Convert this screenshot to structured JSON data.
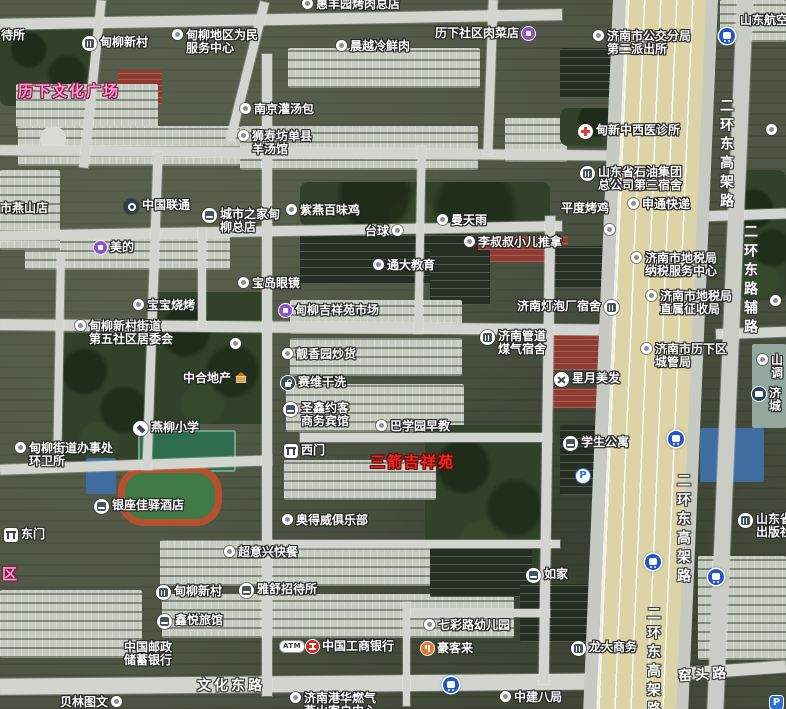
{
  "colors": {
    "poi_text": "#ffffff",
    "area_label_pink": "#ff9cc8",
    "area_label_red": "#ef2723",
    "road_fill": "#d2d5cf",
    "highway_fill": "#dcd3a6"
  },
  "icon_glyphs": {
    "parking": "P",
    "atm": "ATM"
  },
  "area_labels": [
    {
      "text": "历下文化广场",
      "x": 18,
      "y": 80,
      "style": "pink"
    },
    {
      "text": "区",
      "x": 2,
      "y": 563,
      "style": "pink"
    },
    {
      "text": "三箭吉祥苑",
      "x": 370,
      "y": 451,
      "style": "red"
    }
  ],
  "road_labels": [
    {
      "text": "二环东高架路",
      "x": 716,
      "y": 98,
      "vertical": true
    },
    {
      "text": "二环东路辅路",
      "x": 740,
      "y": 224,
      "vertical": true
    },
    {
      "text": "二环东高架路",
      "x": 673,
      "y": 473,
      "vertical": true
    },
    {
      "text": "二环东高架路",
      "x": 643,
      "y": 606,
      "vertical": true
    },
    {
      "text": "窑头路",
      "x": 678,
      "y": 664,
      "vertical": false,
      "tilt": -4
    },
    {
      "text": "文化东路",
      "x": 197,
      "y": 675,
      "vertical": false,
      "tilt": 0
    }
  ],
  "pois": [
    {
      "x": 1,
      "y": 29,
      "icon": "none",
      "lines": [
        "待所"
      ]
    },
    {
      "x": 82,
      "y": 36,
      "icon": "building",
      "lines": [
        "甸柳新村"
      ]
    },
    {
      "x": 172,
      "y": 29,
      "icon": "dot",
      "lines": [
        "甸柳地区为民",
        "服务中心"
      ]
    },
    {
      "x": 302,
      "y": -2,
      "icon": "dot",
      "lines": [
        "惠丰园烤肉总店"
      ]
    },
    {
      "x": 336,
      "y": 40,
      "icon": "dot",
      "lines": [
        "晨越冷鲜肉"
      ]
    },
    {
      "x": 435,
      "y": 27,
      "icon": "purple",
      "side": "r",
      "lines": [
        "历下社区肉菜店"
      ]
    },
    {
      "x": 593,
      "y": 30,
      "icon": "dot",
      "lines": [
        "济南市公交分局",
        "第二派出所"
      ]
    },
    {
      "x": 740,
      "y": 14,
      "icon": "none",
      "lines": [
        "山东航空"
      ]
    },
    {
      "x": 719,
      "y": 28,
      "icon": "metro",
      "lines": []
    },
    {
      "x": 240,
      "y": 103,
      "icon": "dot",
      "lines": [
        "南京灌汤包"
      ]
    },
    {
      "x": 238,
      "y": 130,
      "icon": "dot",
      "lines": [
        "狮寿坊单县",
        "羊汤馆"
      ]
    },
    {
      "x": 578,
      "y": 124,
      "icon": "hospital",
      "lines": [
        "甸新中西医诊所"
      ]
    },
    {
      "x": 580,
      "y": 166,
      "icon": "building",
      "lines": [
        "山东省石油集团",
        "总公司第三宿舍"
      ]
    },
    {
      "x": 561,
      "y": 202,
      "icon": "none",
      "lines": [
        "平度烤鸡"
      ]
    },
    {
      "x": 628,
      "y": 198,
      "icon": "dot",
      "lines": [
        "申通快递"
      ]
    },
    {
      "x": 766,
      "y": 124,
      "icon": "dot",
      "lines": []
    },
    {
      "x": 0,
      "y": 202,
      "icon": "none",
      "lines": [
        "市燕山店"
      ]
    },
    {
      "x": 124,
      "y": 199,
      "icon": "unicom",
      "lines": [
        "中国联通"
      ]
    },
    {
      "x": 202,
      "y": 208,
      "icon": "bed",
      "lines": [
        "城市之家甸",
        "柳总店"
      ]
    },
    {
      "x": 94,
      "y": 241,
      "icon": "purple",
      "lines": [
        "美的"
      ]
    },
    {
      "x": 286,
      "y": 204,
      "icon": "dot",
      "lines": [
        "紫燕百味鸡"
      ]
    },
    {
      "x": 365,
      "y": 225,
      "icon": "dot",
      "side": "r",
      "lines": [
        "台球"
      ]
    },
    {
      "x": 437,
      "y": 214,
      "icon": "dot",
      "lines": [
        "曼天雨"
      ]
    },
    {
      "x": 464,
      "y": 236,
      "icon": "dot",
      "lines": [
        "李叔叔小儿推拿"
      ]
    },
    {
      "x": 373,
      "y": 259,
      "icon": "dot",
      "lines": [
        "通大教育"
      ]
    },
    {
      "x": 238,
      "y": 277,
      "icon": "dot",
      "lines": [
        "宝岛眼镜"
      ]
    },
    {
      "x": 279,
      "y": 304,
      "icon": "purple",
      "lines": [
        "甸柳吉祥苑市场"
      ]
    },
    {
      "x": 517,
      "y": 300,
      "icon": "building",
      "side": "r",
      "lines": [
        "济南灯泡厂宿舍"
      ]
    },
    {
      "x": 631,
      "y": 252,
      "icon": "dot",
      "lines": [
        "济南市地税局",
        "纳税服务中心"
      ]
    },
    {
      "x": 646,
      "y": 290,
      "icon": "dot",
      "lines": [
        "济南市地税局",
        "直属征收局"
      ]
    },
    {
      "x": 480,
      "y": 330,
      "icon": "building",
      "lines": [
        "济南管道",
        "煤气宿舍"
      ]
    },
    {
      "x": 641,
      "y": 343,
      "icon": "dot",
      "lines": [
        "济南市历下区",
        "城管局"
      ]
    },
    {
      "x": 554,
      "y": 372,
      "icon": "scissors",
      "lines": [
        "星月美发"
      ]
    },
    {
      "x": 133,
      "y": 299,
      "icon": "dot",
      "lines": [
        "宝宝烧烤"
      ]
    },
    {
      "x": 75,
      "y": 320,
      "icon": "dot",
      "lines": [
        "甸柳新村街道",
        "第五社区居委会"
      ]
    },
    {
      "x": 183,
      "y": 372,
      "icon": "house",
      "side": "r",
      "lines": [
        "中合地产"
      ]
    },
    {
      "x": 282,
      "y": 348,
      "icon": "dot",
      "lines": [
        "靓香园炒货"
      ]
    },
    {
      "x": 281,
      "y": 376,
      "icon": "bag",
      "lines": [
        "赛维干洗"
      ]
    },
    {
      "x": 283,
      "y": 402,
      "icon": "bed",
      "lines": [
        "圣鑫约客",
        "商务宾馆"
      ]
    },
    {
      "x": 376,
      "y": 420,
      "icon": "dot",
      "lines": [
        "巴学园早教"
      ]
    },
    {
      "x": 284,
      "y": 444,
      "icon": "gate",
      "lines": [
        "西门"
      ]
    },
    {
      "x": 133,
      "y": 421,
      "icon": "school",
      "lines": [
        "燕柳小学"
      ]
    },
    {
      "x": 15,
      "y": 442,
      "icon": "dot",
      "lines": [
        "甸柳街道办事处",
        "环卫所"
      ]
    },
    {
      "x": 563,
      "y": 436,
      "icon": "bed",
      "lines": [
        "学生公寓"
      ]
    },
    {
      "x": 576,
      "y": 469,
      "icon": "parking",
      "lines": []
    },
    {
      "x": 4,
      "y": 528,
      "icon": "gate",
      "lines": [
        "东门"
      ]
    },
    {
      "x": 94,
      "y": 499,
      "icon": "bed",
      "lines": [
        "银座佳驿酒店"
      ]
    },
    {
      "x": 282,
      "y": 514,
      "icon": "dot",
      "lines": [
        "奥得威俱乐部"
      ]
    },
    {
      "x": 224,
      "y": 546,
      "icon": "dot",
      "lines": [
        "超意兴快餐"
      ]
    },
    {
      "x": 156,
      "y": 585,
      "icon": "building",
      "lines": [
        "甸柳新村"
      ]
    },
    {
      "x": 239,
      "y": 583,
      "icon": "bed",
      "lines": [
        "雅舒招待所"
      ]
    },
    {
      "x": 157,
      "y": 614,
      "icon": "bed",
      "lines": [
        "鑫悦旅馆"
      ]
    },
    {
      "x": 124,
      "y": 641,
      "icon": "none",
      "lines": [
        "中国邮政",
        "储蓄银行"
      ]
    },
    {
      "x": 60,
      "y": 696,
      "icon": "dot",
      "side": "r",
      "lines": [
        "贝林图文"
      ]
    },
    {
      "x": 280,
      "y": 641,
      "icon": "atm",
      "lines": []
    },
    {
      "x": 306,
      "y": 640,
      "icon": "icbc",
      "lines": [
        "中国工商银行"
      ]
    },
    {
      "x": 424,
      "y": 619,
      "icon": "dot",
      "lines": [
        "七彩路幼儿园"
      ]
    },
    {
      "x": 421,
      "y": 642,
      "icon": "food",
      "lines": [
        "豪客来"
      ]
    },
    {
      "x": 526,
      "y": 568,
      "icon": "bed",
      "lines": [
        "如家"
      ]
    },
    {
      "x": 571,
      "y": 641,
      "icon": "building",
      "lines": [
        "龙大商务"
      ]
    },
    {
      "x": 500,
      "y": 691,
      "icon": "dot",
      "lines": [
        "中建八局"
      ]
    },
    {
      "x": 290,
      "y": 692,
      "icon": "dot",
      "lines": [
        "济南港华燃气",
        "燕山客户中心"
      ]
    },
    {
      "x": 668,
      "y": 431,
      "icon": "metro",
      "lines": []
    },
    {
      "x": 645,
      "y": 554,
      "icon": "metro",
      "lines": []
    },
    {
      "x": 708,
      "y": 569,
      "icon": "metro",
      "lines": []
    },
    {
      "x": 443,
      "y": 677,
      "icon": "metro",
      "lines": []
    },
    {
      "x": 757,
      "y": 354,
      "icon": "dot",
      "lines": [
        "山",
        "调"
      ]
    },
    {
      "x": 752,
      "y": 387,
      "icon": "bus",
      "lines": [
        "济",
        "城"
      ]
    },
    {
      "x": 738,
      "y": 513,
      "icon": "building",
      "lines": [
        "山东省",
        "出版社"
      ]
    },
    {
      "x": 770,
      "y": 295,
      "icon": "dot",
      "lines": []
    },
    {
      "x": 604,
      "y": 224,
      "icon": "dot",
      "lines": []
    },
    {
      "x": 230,
      "y": 338,
      "icon": "dot",
      "lines": []
    },
    {
      "x": 770,
      "y": 696,
      "icon": "parking2",
      "lines": []
    }
  ]
}
